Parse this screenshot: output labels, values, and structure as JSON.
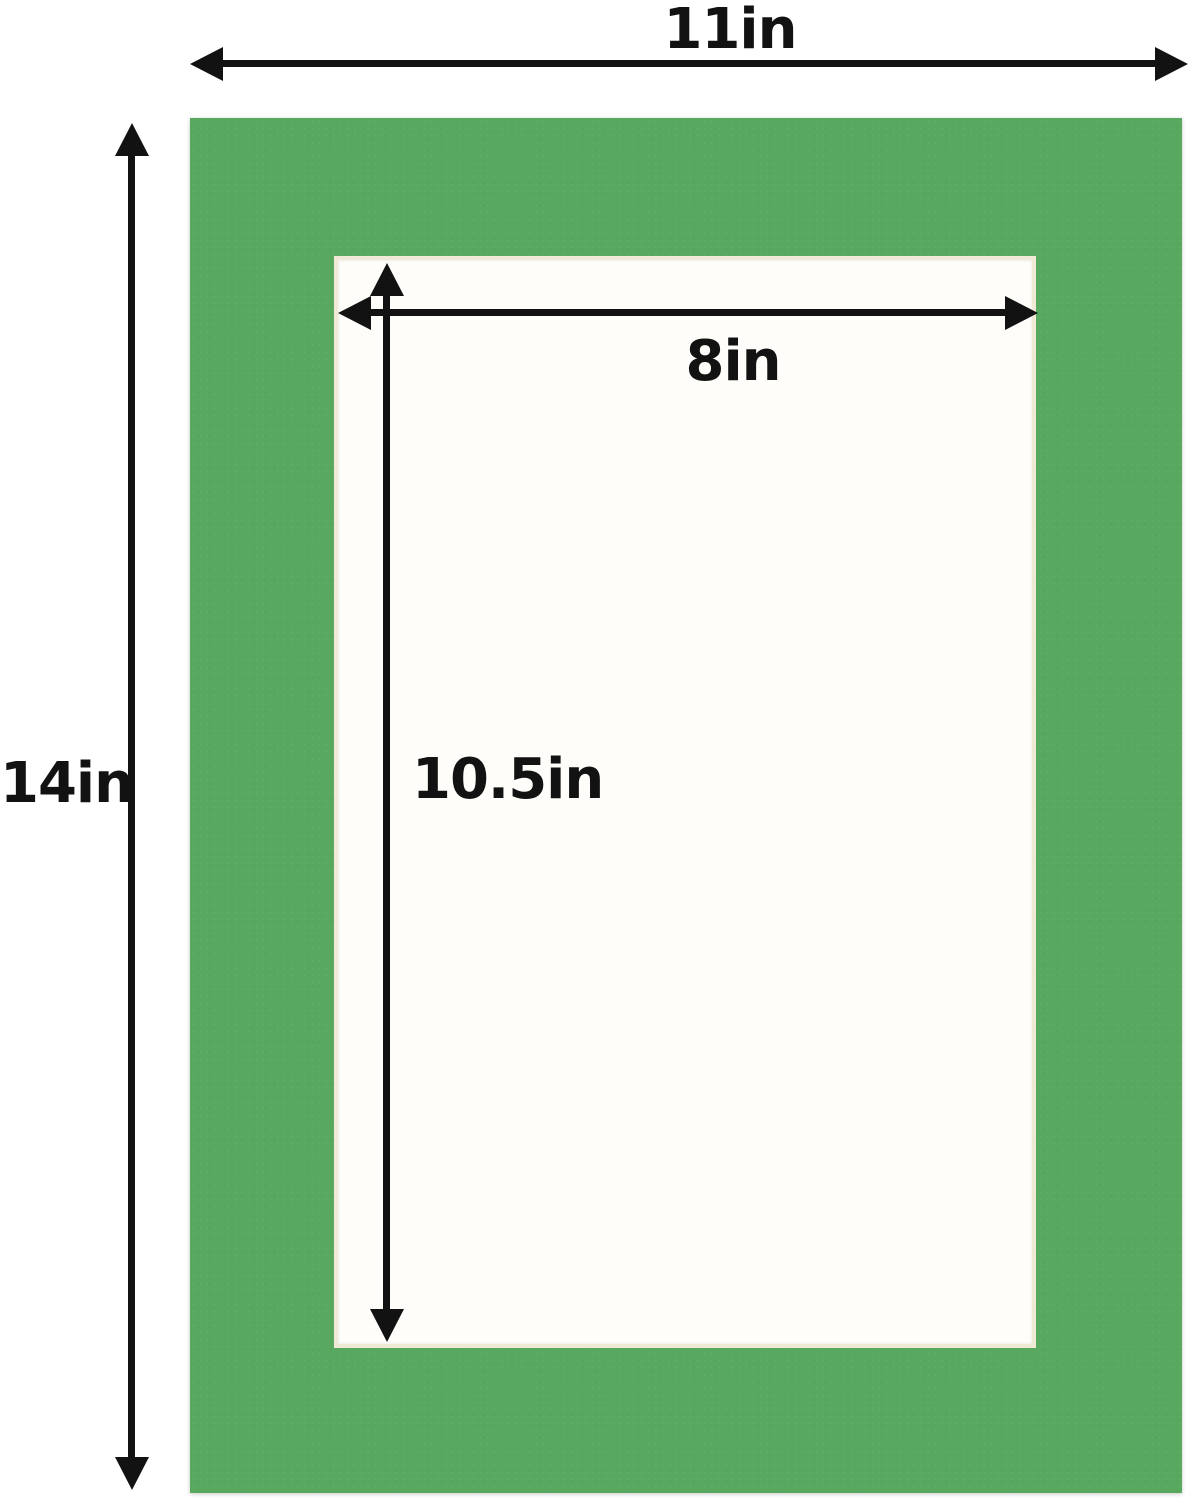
{
  "colors": {
    "page_bg": "#ffffff",
    "mat_green": "#58a95f",
    "mat_core": "#f0e9d6",
    "opening_white": "#fefdfa",
    "arrow_black": "#121212"
  },
  "labels": {
    "outer_width": "11in",
    "outer_height": "14in",
    "opening_width": "8in",
    "opening_height": "10.5in"
  }
}
